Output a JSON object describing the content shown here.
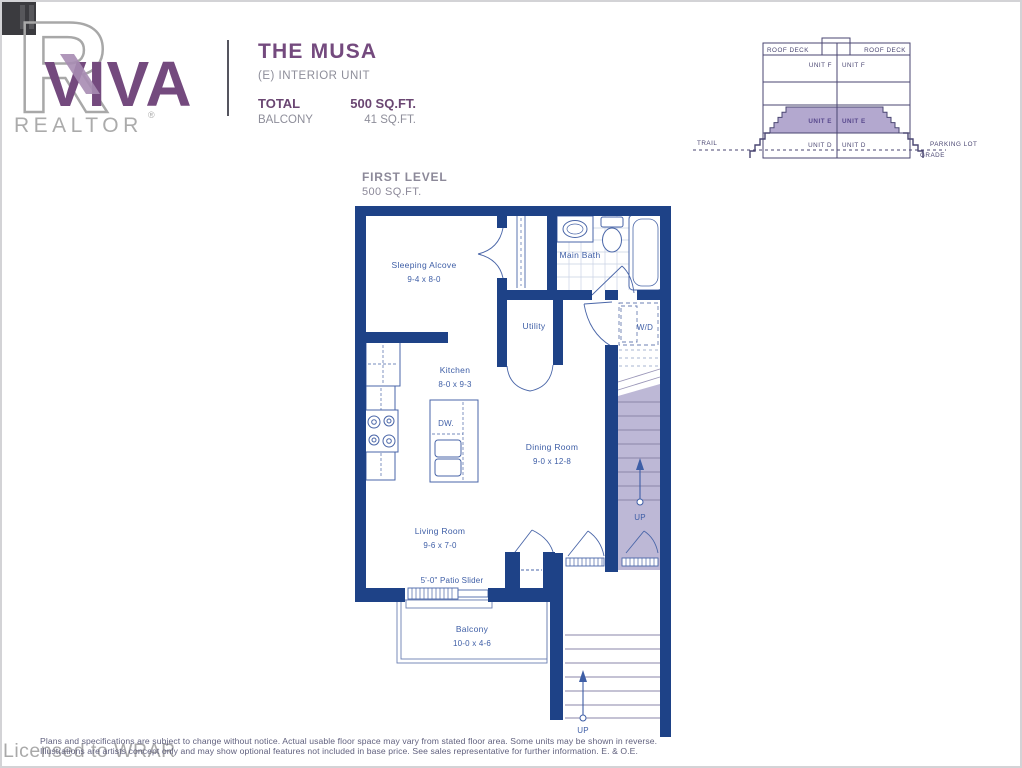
{
  "header": {
    "viva": "VIVA",
    "realtor": "REALTOR",
    "reg": "®",
    "plan_name": "THE MUSA",
    "unit_type": "(E) INTERIOR UNIT",
    "total_label": "TOTAL",
    "total_value": "500 SQ.FT.",
    "balcony_label": "BALCONY",
    "balcony_value": "41 SQ.FT."
  },
  "level": {
    "title": "FIRST LEVEL",
    "area": "500 SQ.FT."
  },
  "cross_section": {
    "roof_deck_left": "ROOF DECK",
    "roof_deck_right": "ROOF DECK",
    "unit_f_left": "UNIT F",
    "unit_f_right": "UNIT F",
    "unit_e_left": "UNIT E",
    "unit_e_right": "UNIT E",
    "unit_d_left": "UNIT D",
    "unit_d_right": "UNIT D",
    "trail": "TRAIL",
    "parking_lot": "PARKING LOT",
    "grade": "GRADE"
  },
  "floor_plan": {
    "rooms": {
      "sleeping_alcove": {
        "name": "Sleeping Alcove",
        "dims": "9-4 x 8-0"
      },
      "main_bath": {
        "name": "Main Bath"
      },
      "utility": {
        "name": "Utility"
      },
      "wd": {
        "name": "W/D"
      },
      "kitchen": {
        "name": "Kitchen",
        "dims": "8-0 x 9-3"
      },
      "dining_room": {
        "name": "Dining Room",
        "dims": "9-0 x 12-8"
      },
      "living_room": {
        "name": "Living Room",
        "dims": "9-6 x 7-0"
      },
      "balcony": {
        "name": "Balcony",
        "dims": "10-0 x 4-6"
      }
    },
    "labels": {
      "dw": "DW.",
      "patio_slider": "5'-0\" Patio Slider",
      "up_interior": "UP",
      "up_exterior": "UP"
    }
  },
  "colors": {
    "wall": "#1e4287",
    "fixture_line": "#4a66a8",
    "plan_text": "#3e5ea6",
    "stair_fill": "#bdb8d6",
    "accent_purple": "#744a7e",
    "section_outline": "#4a4672",
    "section_highlight": "#b3a8cf",
    "gray_text": "#8e8e9a"
  },
  "footer": {
    "line1": "Plans and specifications are subject to change without notice.  Actual usable floor space may vary from stated floor area.  Some units may be shown in reverse.",
    "line2": "Illustrations are artists concept only and may show optional features not included in base price.  See sales representative for further information. E. & O.E.",
    "watermark": "Licensed to WRAR"
  }
}
